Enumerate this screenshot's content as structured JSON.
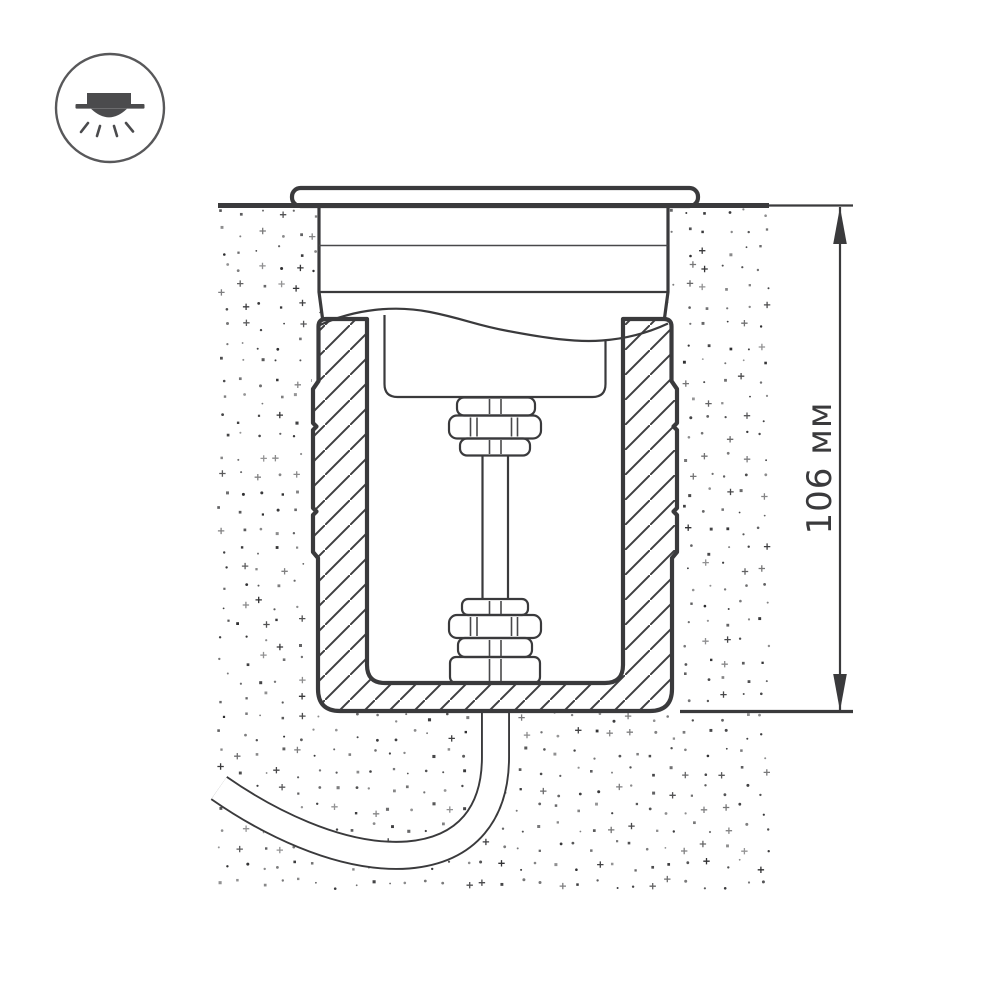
{
  "page": {
    "background": "#ffffff"
  },
  "colors": {
    "line": "#3a3a3c",
    "thin_line": "#48484a",
    "icon": "#4b4b4d",
    "stipple": "#2e2e30"
  },
  "header_icon": {
    "name": "recessed-downlight-icon"
  },
  "diagram": {
    "kind": "installation-cross-section",
    "dimension": {
      "label": "106 мм"
    }
  }
}
